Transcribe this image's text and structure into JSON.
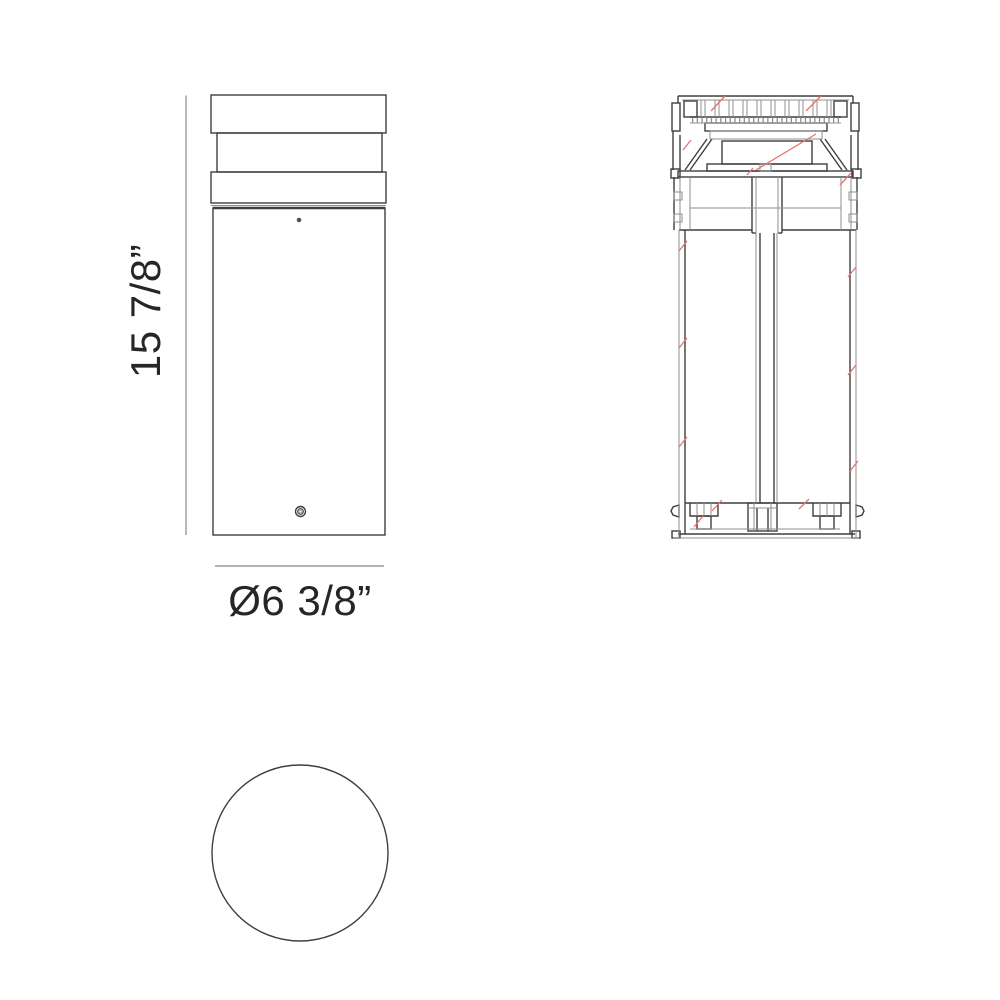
{
  "page": {
    "background": "#ffffff",
    "description": "Technical dimension drawing of a cylindrical bollard light fixture: front elevation, sectional elevation with red section marks, and circular top view"
  },
  "drawing": {
    "dimensions": {
      "height": {
        "label": "15 7/8”"
      },
      "diameter": {
        "label": "Ø6 3/8”"
      }
    },
    "colors": {
      "line_dark": "#3f3f3f",
      "line_light": "#8f8f8f",
      "dim_line": "#8a8a8a",
      "underline": "#9a9a9a",
      "text": "#262626",
      "section_red": "#e87272"
    }
  }
}
